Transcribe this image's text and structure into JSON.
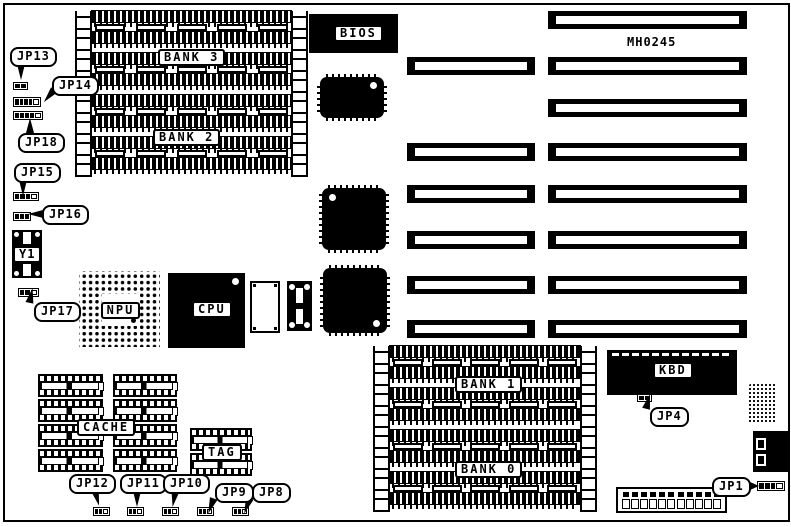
{
  "board": {
    "part_number": "MH0245",
    "colors": {
      "ink": "#000000",
      "paper": "#ffffff"
    }
  },
  "memory": {
    "banks": [
      {
        "id": "bank3",
        "label": "BANK 3"
      },
      {
        "id": "bank2",
        "label": "BANK 2"
      },
      {
        "id": "bank1",
        "label": "BANK 1"
      },
      {
        "id": "bank0",
        "label": "BANK 0"
      }
    ]
  },
  "chips": {
    "bios": "BIOS",
    "cpu": "CPU",
    "npu": "NPU",
    "kbd": "KBD",
    "cache": "CACHE",
    "tag": "TAG",
    "crystal": "Y1"
  },
  "jumpers": {
    "jp13": "JP13",
    "jp14": "JP14",
    "jp18": "JP18",
    "jp15": "JP15",
    "jp16": "JP16",
    "jp17": "JP17",
    "jp12": "JP12",
    "jp11": "JP11",
    "jp10": "JP10",
    "jp9": "JP9",
    "jp8": "JP8",
    "jp4": "JP4",
    "jp1": "JP1"
  }
}
